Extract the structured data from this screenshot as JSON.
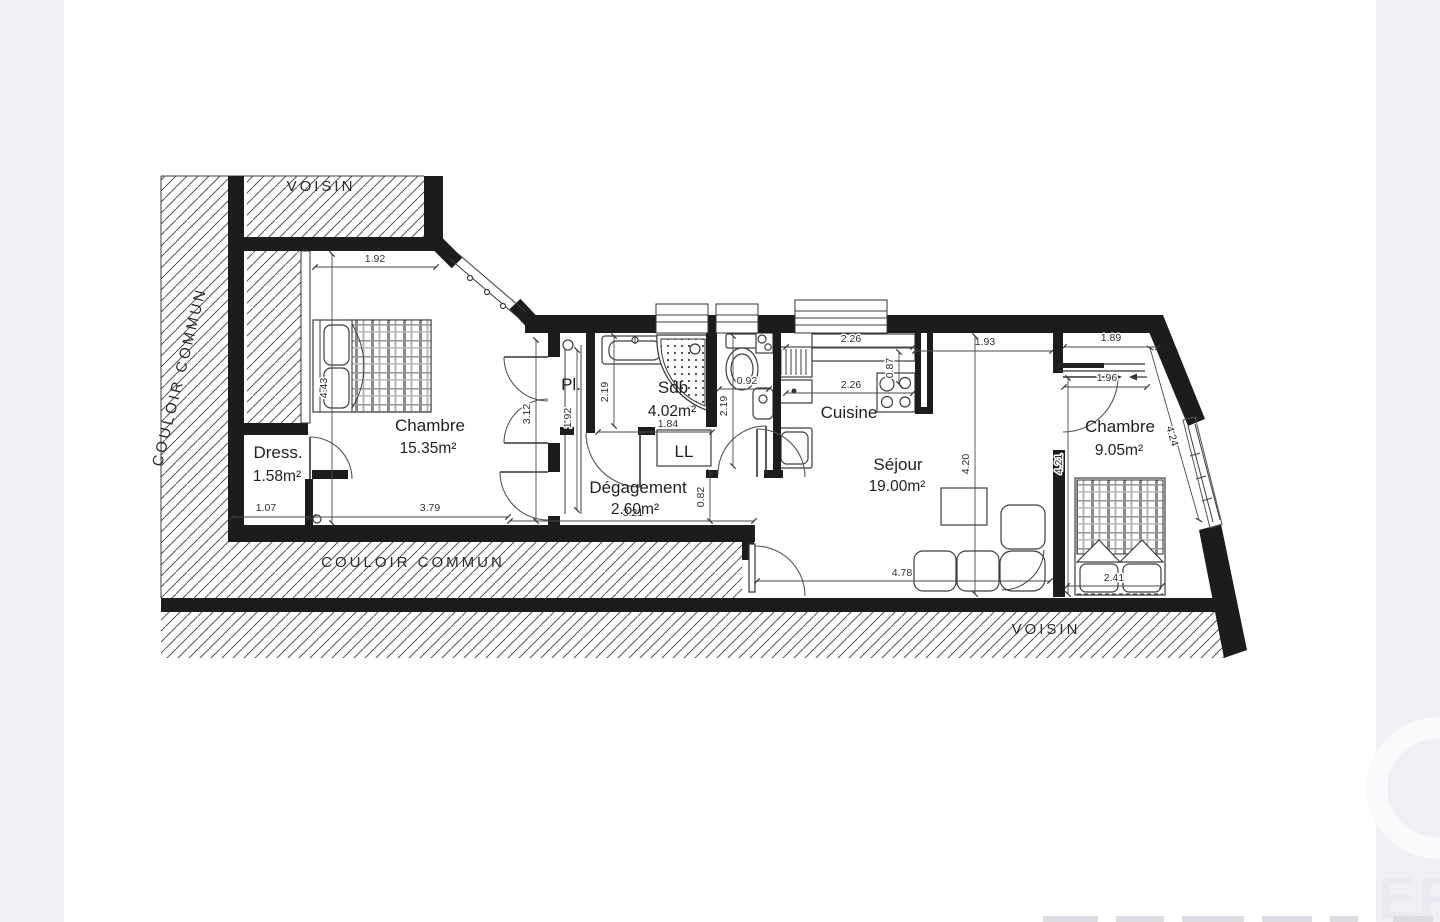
{
  "page": {
    "background": "#ffffff",
    "margin_color": "#f0f0f4"
  },
  "zones": {
    "voisin_top": "VOISIN",
    "voisin_bottom": "VOISIN",
    "couloir_left": "COULOIR COMMUN",
    "couloir_bottom": "COULOIR COMMUN"
  },
  "rooms": [
    {
      "name": "Chambre",
      "area": "15.35m²"
    },
    {
      "name": "Dress.",
      "area": "1.58m²"
    },
    {
      "name": "Pl.",
      "area": ""
    },
    {
      "name": "Sdb",
      "area": "4.02m²"
    },
    {
      "name": "LL",
      "area": ""
    },
    {
      "name": "Dégagement",
      "area": "2.60m²"
    },
    {
      "name": "Cuisine",
      "area": ""
    },
    {
      "name": "Séjour",
      "area": "19.00m²"
    },
    {
      "name": "Chambre",
      "area": "9.05m²"
    }
  ],
  "dimensions": {
    "chambre1_width_top": "1.92",
    "chambre1_height": "4.43",
    "chambre1_width_bottom": "3.79",
    "dress_width": "1.07",
    "chambre1_right_height": "3.12",
    "placard_height": "1.92",
    "sdb_height": "2.19",
    "sdb_width": "1.84",
    "wc_width": "0.92",
    "wc_height": "2.19",
    "cuisine_top": "2.26",
    "cuisine_bottom": "2.26",
    "cuisine_depth": "0.87",
    "sejour_width_top": "1.93",
    "sejour_height": "4.20",
    "chambre2_width_top": "1.89",
    "chambre2_door": "1.96",
    "chambre2_height": "4.21",
    "chambre2_slant": "4.24",
    "sejour_width_bottom": "4.78",
    "chambre2_bed": "2.41",
    "degagement_width": "3.21",
    "degagement_height": "0.82"
  },
  "watermark": {
    "text": "ER"
  },
  "colors": {
    "wall": "#1c1c1c",
    "line": "#3d3d3d",
    "hatch": "#555555",
    "dim_text": "#2e2e2e",
    "watermark": "#e9e9f1"
  }
}
